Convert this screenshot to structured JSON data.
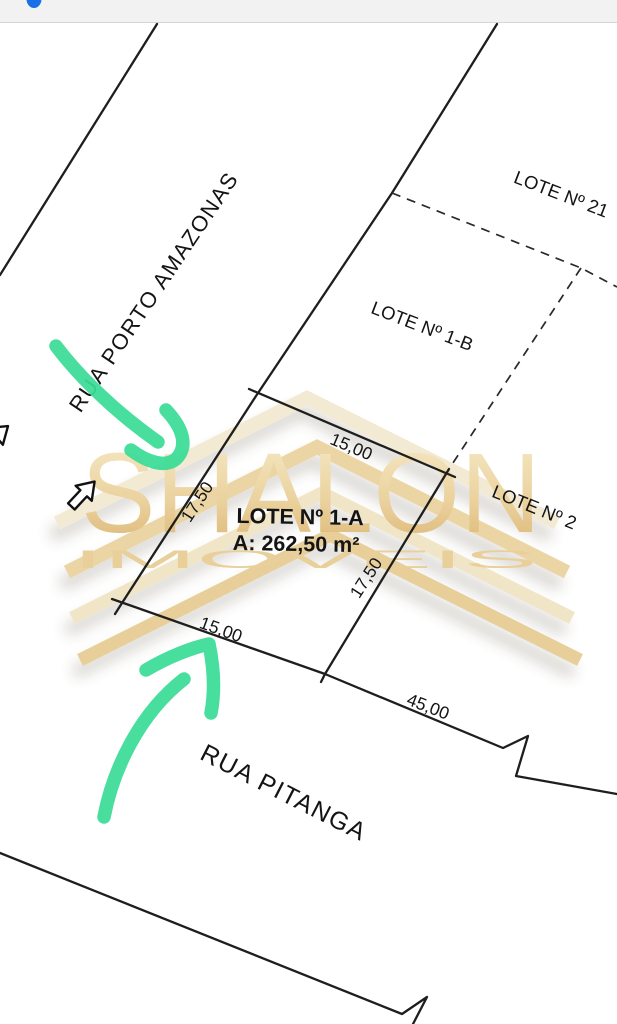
{
  "status_bar": {
    "background": "#f2f2f3",
    "dot_color": "#1b6fe6"
  },
  "plan": {
    "line_color": "#1e1e1e",
    "streets": {
      "porto_amazonas": "RUA PORTO AMAZONAS",
      "pitanga": "RUA PITANGA"
    },
    "lots": {
      "lot_21": {
        "label": "LOTE Nº 21"
      },
      "lot_1b": {
        "label": "LOTE Nº 1-B"
      },
      "lot_2": {
        "label": "LOTE Nº 2"
      },
      "lot_1a": {
        "label": "LOTE Nº 1-A",
        "area": "A: 262,50 m²"
      }
    },
    "dimensions": {
      "lot_1a_width_top": "15,00",
      "lot_1a_side_west": "17,50",
      "lot_1a_side_east": "17,50",
      "lot_1a_width_bottom": "15,00",
      "pitanga_frontage_total": "45,00"
    }
  },
  "watermark": {
    "brand": "SHALON",
    "brand_subtitle": "IMÓVEIS",
    "gold_color": "#E7C98E"
  },
  "annotations": {
    "highlighter_color": "#3BDC96"
  }
}
